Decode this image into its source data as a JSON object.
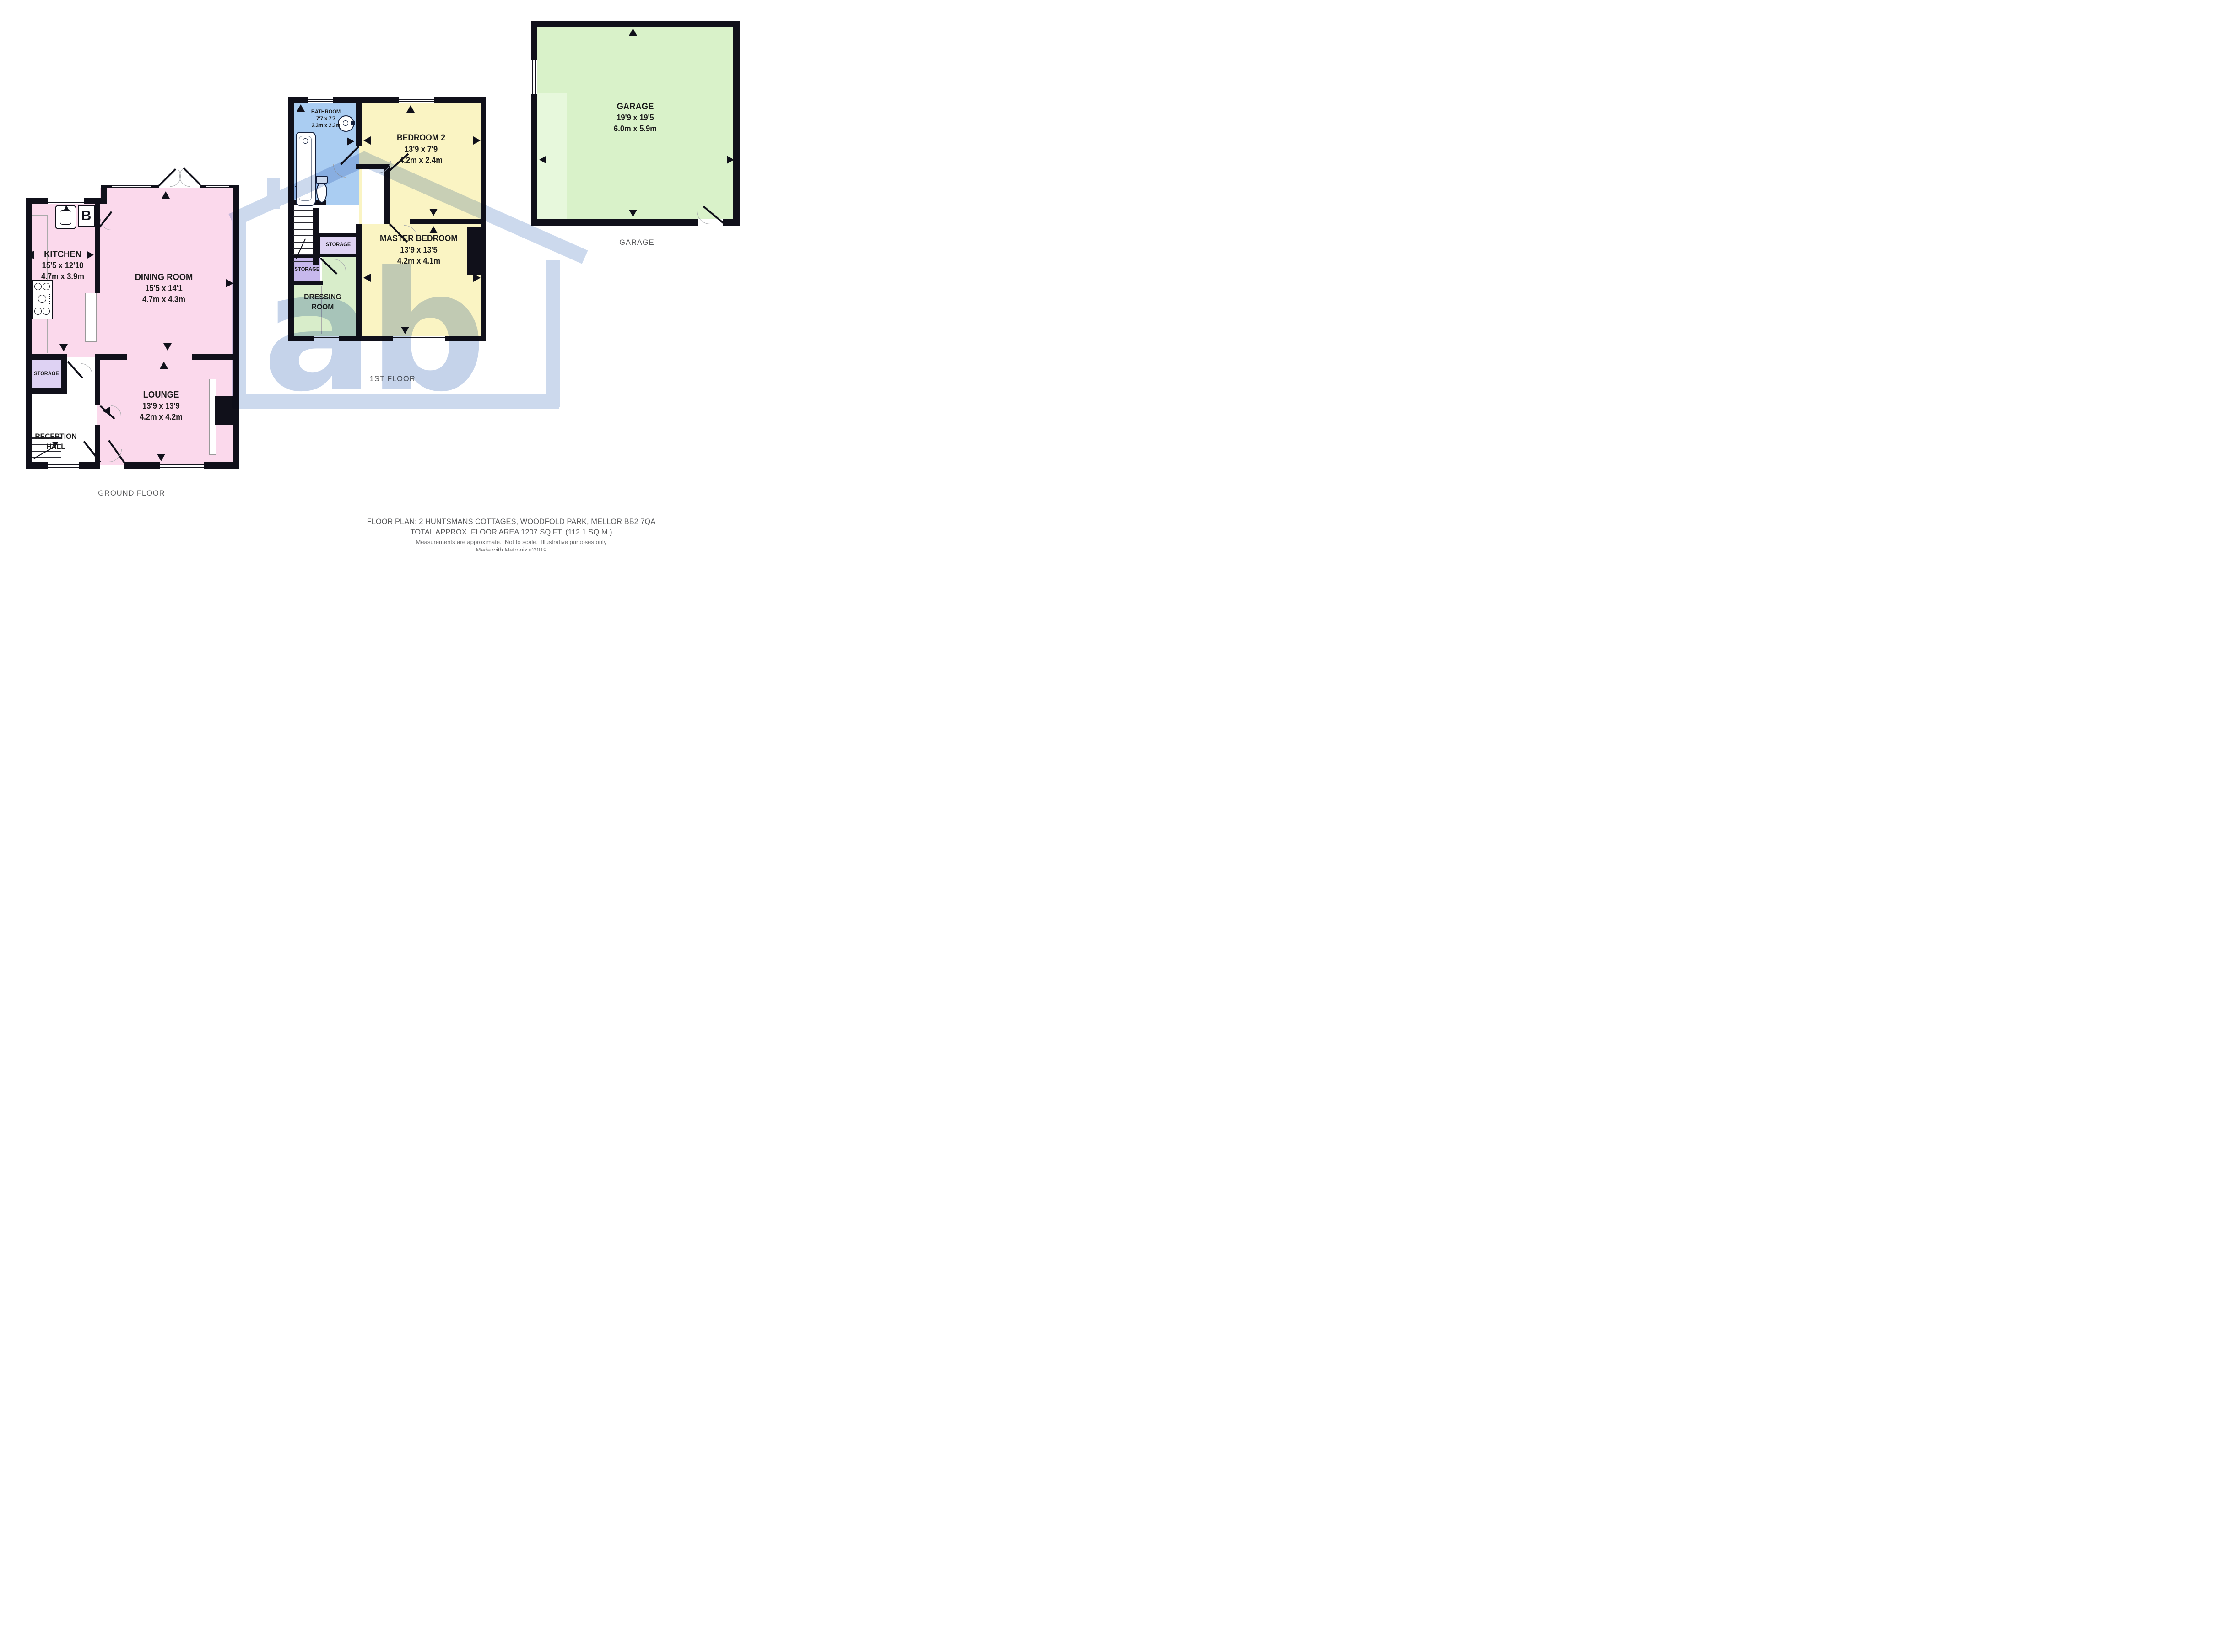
{
  "ground_floor": {
    "caption": "GROUND FLOOR",
    "kitchen": {
      "name": "KITCHEN",
      "size_imperial": "15'5 x 12'10",
      "size_metric": "4.7m x 3.9m"
    },
    "dining_room": {
      "name": "DINING ROOM",
      "size_imperial": "15'5 x 14'1",
      "size_metric": "4.7m x 4.3m"
    },
    "lounge": {
      "name": "LOUNGE",
      "size_imperial": "13'9 x 13'9",
      "size_metric": "4.2m x 4.2m"
    },
    "storage": {
      "name": "STORAGE"
    },
    "reception_hall": {
      "line1": "RECEPTION",
      "line2": "HALL"
    },
    "boiler_label": "B"
  },
  "first_floor": {
    "caption": "1ST FLOOR",
    "bathroom": {
      "name": "BATHROOM",
      "size_imperial": "7'7 x 7'7",
      "size_metric": "2.3m x 2.3m"
    },
    "bedroom2": {
      "name": "BEDROOM 2",
      "size_imperial": "13'9 x 7'9",
      "size_metric": "4.2m x 2.4m"
    },
    "master_bedroom": {
      "name": "MASTER BEDROOM",
      "size_imperial": "13'9 x 13'5",
      "size_metric": "4.2m x 4.1m"
    },
    "storage_upper": {
      "name": "STORAGE"
    },
    "storage_lower": {
      "name": "STORAGE"
    },
    "dressing_room": {
      "line1": "DRESSING",
      "line2": "ROOM"
    }
  },
  "garage_floor": {
    "caption": "GARAGE",
    "garage": {
      "name": "GARAGE",
      "size_imperial": "19'9 x 19'5",
      "size_metric": "6.0m x 5.9m"
    }
  },
  "watermark": {
    "letters": "ab"
  },
  "footer": {
    "line1": "FLOOR PLAN: 2 HUNTSMANS COTTAGES, WOODFOLD PARK, MELLOR BB2 7QA",
    "line2": "TOTAL APPROX. FLOOR AREA 1207 SQ.FT. (112.1 SQ.M.)",
    "line3": "Measurements are approximate.  Not to scale.  Illustrative purposes only",
    "line4": "Made with Metropix ©2019"
  },
  "icons": {
    "sink": "sink-icon",
    "boiler": "boiler-icon",
    "hob": "hob-icon",
    "bath": "bath-icon",
    "basin": "basin-icon",
    "toilet": "toilet-icon",
    "stairs": "stairs-icon",
    "direction_arrow": "triangle-arrow-icon",
    "watermark_house": "house-logo-icon"
  },
  "colors": {
    "room_pink": "#fbd9ec",
    "room_yellow": "#faf4c3",
    "room_blue": "#aacdf2",
    "room_green": "#d8edca",
    "garage_green": "#d9f2c9",
    "garage_green_light": "#e7f8dc",
    "storage_lilac": "#ded2f3",
    "storage_purple": "#c7b8ec",
    "wall": "#10101a",
    "watermark_blue": "#ccd9ed",
    "caption_gray": "#58595b"
  }
}
